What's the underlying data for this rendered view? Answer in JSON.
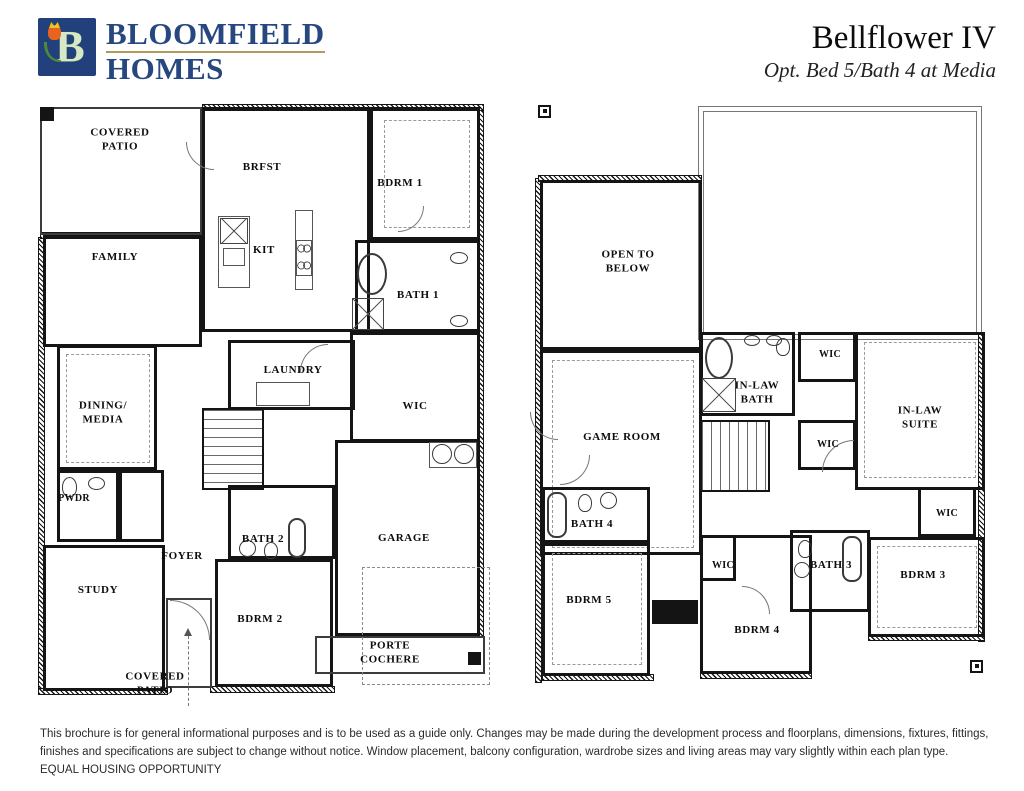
{
  "header": {
    "brand_line1": "BLOOMFIELD",
    "brand_line2": "HOMES",
    "logo": {
      "monogram": "B"
    },
    "plan_title": "Bellflower IV",
    "plan_subtitle": "Opt. Bed 5/Bath 4 at Media"
  },
  "floor1": {
    "rooms": [
      {
        "label": "COVERED\nPATIO"
      },
      {
        "label": "BRFST"
      },
      {
        "label": "BDRM 1"
      },
      {
        "label": "FAMILY"
      },
      {
        "label": "KIT"
      },
      {
        "label": "BATH 1"
      },
      {
        "label": "LAUNDRY"
      },
      {
        "label": "WIC"
      },
      {
        "label": "DINING/\nMEDIA"
      },
      {
        "label": "PWDR"
      },
      {
        "label": "FOYER"
      },
      {
        "label": "BATH 2"
      },
      {
        "label": "STUDY"
      },
      {
        "label": "BDRM 2"
      },
      {
        "label": "GARAGE"
      },
      {
        "label": "PORTE\nCOCHERE"
      },
      {
        "label": "COVERED\nPATIO"
      }
    ]
  },
  "floor2": {
    "rooms": [
      {
        "label": "OPEN TO\nBELOW"
      },
      {
        "label": "WIC"
      },
      {
        "label": "IN-LAW\nBATH"
      },
      {
        "label": "GAME ROOM"
      },
      {
        "label": "WIC"
      },
      {
        "label": "IN-LAW\nSUITE"
      },
      {
        "label": "WIC"
      },
      {
        "label": "BATH 4"
      },
      {
        "label": "BATH 3"
      },
      {
        "label": "WIC"
      },
      {
        "label": "BDRM 3"
      },
      {
        "label": "BDRM 5"
      },
      {
        "label": "BDRM 4"
      }
    ]
  },
  "footer": {
    "disclaimer": "This brochure is for general informational purposes and is to be used as a guide only. Changes may be made during the development process and floorplans, dimensions, fixtures, fittings, finishes and specifications are subject to change without notice. Window placement, balcony configuration, wardrobe sizes and living areas may vary slightly within each plan type.  EQUAL HOUSING OPPORTUNITY"
  },
  "colors": {
    "brand_navy": "#27477f",
    "logo_square_blue": "#21407c",
    "logo_underline_gold": "#b29a5b",
    "wall_black": "#141414",
    "tulip_orange": "#e8641e",
    "leaf_green": "#4e8a3a"
  }
}
